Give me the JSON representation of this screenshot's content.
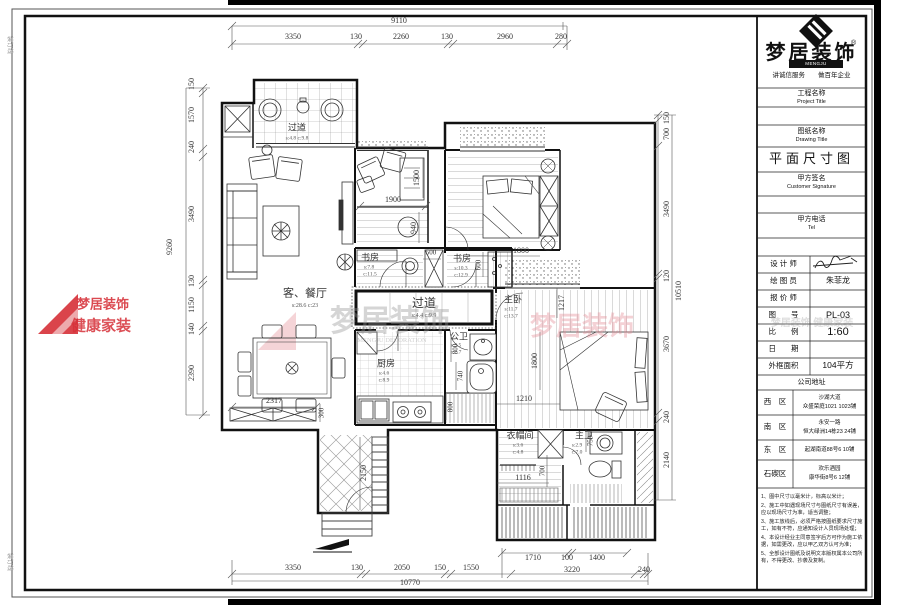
{
  "title_block": {
    "logo_text": "梦居装饰",
    "logo_reg": "®",
    "logo_sub": "MENGJU DECORATION",
    "slogan": "讲诚信服务　　做百年企业",
    "project_label_cn": "工程名称",
    "project_label_en": "Project Title",
    "drawing_label_cn": "图纸名称",
    "drawing_label_en": "Drawing Title",
    "drawing_title": "平面尺寸图",
    "signature_label_cn": "甲方签名",
    "signature_label_en": "Customer Signature",
    "tel_label_cn": "甲方电话",
    "tel_label_en": "Tel",
    "rows": [
      {
        "label": "设 计 师",
        "value": ""
      },
      {
        "label": "绘 图 员",
        "value": "朱菲龙"
      },
      {
        "label": "报 价 师",
        "value": ""
      },
      {
        "label": "图　　号",
        "value": "PL-03"
      },
      {
        "label": "比　　例",
        "value": "1:60"
      },
      {
        "label": "日　　期",
        "value": ""
      },
      {
        "label": "外框面积",
        "value": "104平方"
      }
    ],
    "address_header": "公司地址",
    "addresses": [
      {
        "district": "西　区",
        "line1": "沙湖大道",
        "line2": "众盛荣庭1021  1023铺"
      },
      {
        "district": "南　区",
        "line1": "永安一路",
        "line2": "恒大绿洲14栋23  24铺"
      },
      {
        "district": "东　区",
        "line1": "起湖南道88号6  10铺",
        "line2": ""
      },
      {
        "district": "石碶区",
        "line1": "欢乐酒园",
        "line2": "康华街8号6  12铺"
      }
    ],
    "notes": [
      "1、图中尺寸以毫米计，标高以米计；",
      "2、施工中如遇现场尺寸与图纸尺寸有误差，应以现场尺寸为准，适当调整；",
      "3、施工放线后，必须严格按图纸要求尺寸施工，如有不符，应通知设计人员现场处理；",
      "4、本设计经业主同意签字后方可作为施工依据，如需更改，应以甲乙双方认可为准；",
      "5、全部设计图纸及说明文本版权属本公司所有，不得更改、抄袭及复制。"
    ]
  },
  "accent_colors": {
    "brand_red": "#d63038",
    "line_dark": "#111111"
  },
  "plan": {
    "texts": [
      {
        "n": "dim-top-overall",
        "t": "9110",
        "x": 399,
        "y": 21
      },
      {
        "n": "dim",
        "t": "3350",
        "x": 293,
        "y": 37
      },
      {
        "n": "dim",
        "t": "130",
        "x": 356,
        "y": 37
      },
      {
        "n": "dim",
        "t": "2260",
        "x": 401,
        "y": 37
      },
      {
        "n": "dim",
        "t": "130",
        "x": 447,
        "y": 37
      },
      {
        "n": "dim",
        "t": "2960",
        "x": 505,
        "y": 37
      },
      {
        "n": "dim",
        "t": "280",
        "x": 561,
        "y": 37
      },
      {
        "n": "dim",
        "t": "1710",
        "x": 533,
        "y": 558
      },
      {
        "n": "dim",
        "t": "100",
        "x": 567,
        "y": 558
      },
      {
        "n": "dim",
        "t": "1400",
        "x": 597,
        "y": 558
      },
      {
        "n": "dim",
        "t": "3350",
        "x": 293,
        "y": 568
      },
      {
        "n": "dim",
        "t": "130",
        "x": 357,
        "y": 568
      },
      {
        "n": "dim",
        "t": "2050",
        "x": 402,
        "y": 568
      },
      {
        "n": "dim",
        "t": "150",
        "x": 440,
        "y": 568
      },
      {
        "n": "dim",
        "t": "1550",
        "x": 471,
        "y": 568
      },
      {
        "n": "dim",
        "t": "3220",
        "x": 572,
        "y": 570
      },
      {
        "n": "dim",
        "t": "240",
        "x": 644,
        "y": 570
      },
      {
        "n": "dim-bottom-overall",
        "t": "10770",
        "x": 410,
        "y": 583
      },
      {
        "n": "dim-left-overall",
        "t": "9260",
        "x": 170,
        "y": 247,
        "r": -90
      },
      {
        "n": "dim",
        "t": "150",
        "x": 192,
        "y": 84,
        "r": -90
      },
      {
        "n": "dim",
        "t": "1570",
        "x": 192,
        "y": 115,
        "r": -90
      },
      {
        "n": "dim",
        "t": "240",
        "x": 192,
        "y": 147,
        "r": -90
      },
      {
        "n": "dim",
        "t": "3490",
        "x": 192,
        "y": 214,
        "r": -90
      },
      {
        "n": "dim",
        "t": "130",
        "x": 192,
        "y": 281,
        "r": -90
      },
      {
        "n": "dim",
        "t": "1150",
        "x": 192,
        "y": 305,
        "r": -90
      },
      {
        "n": "dim",
        "t": "140",
        "x": 192,
        "y": 329,
        "r": -90
      },
      {
        "n": "dim",
        "t": "2390",
        "x": 192,
        "y": 373,
        "r": -90
      },
      {
        "n": "dim",
        "t": "150",
        "x": 667,
        "y": 118,
        "r": -90
      },
      {
        "n": "dim",
        "t": "700",
        "x": 667,
        "y": 134,
        "r": -90
      },
      {
        "n": "dim",
        "t": "3490",
        "x": 667,
        "y": 209,
        "r": -90
      },
      {
        "n": "dim",
        "t": "120",
        "x": 667,
        "y": 276,
        "r": -90
      },
      {
        "n": "dim-right-overall",
        "t": "10510",
        "x": 679,
        "y": 291,
        "r": -90
      },
      {
        "n": "dim",
        "t": "3670",
        "x": 667,
        "y": 344,
        "r": -90
      },
      {
        "n": "dim",
        "t": "240",
        "x": 667,
        "y": 417,
        "r": -90
      },
      {
        "n": "dim",
        "t": "2140",
        "x": 667,
        "y": 460,
        "r": -90
      },
      {
        "n": "dim",
        "t": "1900",
        "x": 393,
        "y": 200
      },
      {
        "n": "dim",
        "t": "1500",
        "x": 417,
        "y": 178,
        "r": -90
      },
      {
        "n": "dim",
        "t": "940",
        "x": 414,
        "y": 228,
        "r": -90
      },
      {
        "n": "dim",
        "t": "1800",
        "x": 521,
        "y": 251
      },
      {
        "n": "dim",
        "t": "500",
        "x": 431,
        "y": 253,
        "fs": 7
      },
      {
        "n": "dim",
        "t": "600",
        "x": 479,
        "y": 265,
        "r": -90,
        "fs": 7
      },
      {
        "n": "dim",
        "t": "1217",
        "x": 562,
        "y": 303,
        "r": -90
      },
      {
        "n": "dim",
        "t": "1800",
        "x": 535,
        "y": 361,
        "r": -90
      },
      {
        "n": "dim",
        "t": "1210",
        "x": 524,
        "y": 399
      },
      {
        "n": "dim",
        "t": "800",
        "x": 456,
        "y": 349,
        "r": -90,
        "fs": 7
      },
      {
        "n": "dim",
        "t": "740",
        "x": 461,
        "y": 376,
        "r": -90,
        "fs": 7
      },
      {
        "n": "dim",
        "t": "800",
        "x": 451,
        "y": 407,
        "r": -90,
        "fs": 7
      },
      {
        "n": "dim",
        "t": "750",
        "x": 591,
        "y": 441,
        "r": -90,
        "fs": 7
      },
      {
        "n": "dim",
        "t": "700",
        "x": 543,
        "y": 471,
        "r": -90,
        "fs": 7
      },
      {
        "n": "dim",
        "t": "1116",
        "x": 523,
        "y": 478
      },
      {
        "n": "dim",
        "t": "2317",
        "x": 274,
        "y": 401
      },
      {
        "n": "dim",
        "t": "300",
        "x": 322,
        "y": 413,
        "r": -90,
        "fs": 7
      },
      {
        "n": "dim",
        "t": "2150",
        "x": 364,
        "y": 473,
        "r": -90
      },
      {
        "n": "room-label",
        "t": "过道",
        "x": 297,
        "y": 128,
        "fs": 9
      },
      {
        "n": "room-sub",
        "t": "s:4.8 c:9.8",
        "x": 297,
        "y": 139,
        "fs": 5.5,
        "c": "#555"
      },
      {
        "n": "room-label",
        "t": "客、餐厅",
        "x": 305,
        "y": 294,
        "fs": 11
      },
      {
        "n": "room-sub",
        "t": "s:28.6 c:23",
        "x": 305,
        "y": 306,
        "fs": 6,
        "c": "#555"
      },
      {
        "n": "room-label",
        "t": "书房",
        "x": 370,
        "y": 258,
        "fs": 9
      },
      {
        "n": "room-sub",
        "t": "s:7.8",
        "x": 369,
        "y": 268,
        "fs": 5.5,
        "c": "#555"
      },
      {
        "n": "room-sub",
        "t": "c:11.5",
        "x": 370,
        "y": 275,
        "fs": 5.5,
        "c": "#555"
      },
      {
        "n": "room-label",
        "t": "书房",
        "x": 462,
        "y": 259,
        "fs": 9
      },
      {
        "n": "room-sub",
        "t": "s:10.3",
        "x": 461,
        "y": 269,
        "fs": 5.5,
        "c": "#555"
      },
      {
        "n": "room-sub",
        "t": "c:12.9",
        "x": 461,
        "y": 276,
        "fs": 5.5,
        "c": "#555"
      },
      {
        "n": "room-label",
        "t": "过道",
        "x": 424,
        "y": 303,
        "fs": 12
      },
      {
        "n": "room-sub",
        "t": "s:4.4 c:9.9",
        "x": 424,
        "y": 316,
        "fs": 6,
        "c": "#555"
      },
      {
        "n": "room-label",
        "t": "主卧",
        "x": 513,
        "y": 300,
        "fs": 9
      },
      {
        "n": "room-sub",
        "t": "s:11.7",
        "x": 511,
        "y": 310,
        "fs": 5.5,
        "c": "#555"
      },
      {
        "n": "room-sub",
        "t": "c:13.7",
        "x": 511,
        "y": 317,
        "fs": 5.5,
        "c": "#555"
      },
      {
        "n": "room-label",
        "t": "厨房",
        "x": 386,
        "y": 364,
        "fs": 9
      },
      {
        "n": "room-sub",
        "t": "s:4.6",
        "x": 384,
        "y": 374,
        "fs": 5.5,
        "c": "#555"
      },
      {
        "n": "room-sub",
        "t": "c:8.9",
        "x": 384,
        "y": 381,
        "fs": 5.5,
        "c": "#555"
      },
      {
        "n": "room-label",
        "t": "公卫",
        "x": 459,
        "y": 337,
        "fs": 9
      },
      {
        "n": "room-sub",
        "t": "s:3.5",
        "x": 456,
        "y": 346,
        "fs": 5.5,
        "c": "#555"
      },
      {
        "n": "room-sub",
        "t": "c:7.7",
        "x": 456,
        "y": 353,
        "fs": 5.5,
        "c": "#555"
      },
      {
        "n": "room-label",
        "t": "衣帽间",
        "x": 520,
        "y": 436,
        "fs": 9
      },
      {
        "n": "room-sub",
        "t": "s:3.6",
        "x": 518,
        "y": 446,
        "fs": 5.5,
        "c": "#555"
      },
      {
        "n": "room-sub",
        "t": "c:4.8",
        "x": 518,
        "y": 453,
        "fs": 5.5,
        "c": "#555"
      },
      {
        "n": "room-label",
        "t": "主卫",
        "x": 584,
        "y": 436,
        "fs": 9
      },
      {
        "n": "room-sub",
        "t": "s:2.9",
        "x": 577,
        "y": 446,
        "fs": 5.5,
        "c": "#555"
      },
      {
        "n": "room-sub",
        "t": "c:7.0",
        "x": 577,
        "y": 453,
        "fs": 5.5,
        "c": "#555"
      },
      {
        "n": "watermark-center-text",
        "t": "梦居装饰",
        "x": 390,
        "y": 322,
        "fs": 30,
        "c": "rgba(145,145,145,0.38)",
        "w": "bold"
      },
      {
        "n": "watermark-center-sub",
        "t": "MENGJU DECORATION",
        "x": 392,
        "y": 341,
        "fs": 6.5,
        "c": "rgba(150,150,150,0.45)"
      },
      {
        "n": "watermark-center-dots",
        "t": "·   ·   ·   ·   ·   ·",
        "x": 392,
        "y": 349,
        "fs": 6,
        "c": "rgba(160,160,160,0.4)"
      },
      {
        "n": "watermark-right-text",
        "t": "梦居装饰",
        "x": 582,
        "y": 327,
        "fs": 26,
        "c": "rgba(228,140,150,0.4)",
        "w": "bold"
      },
      {
        "n": "watermark-left-title",
        "t": "梦居装饰",
        "x": 103,
        "y": 304,
        "fs": 13,
        "c": "rgba(214,48,56,0.88)",
        "w": "bold"
      },
      {
        "n": "watermark-left-sub",
        "t": "健康家装",
        "x": 101,
        "y": 327,
        "fs": 15,
        "c": "rgba(214,48,56,0.85)",
        "w": "bold"
      },
      {
        "n": "watermark-titleblock",
        "t": "梦居装饰 健康家装",
        "x": 812,
        "y": 324,
        "fs": 10,
        "c": "rgba(150,150,150,0.32)",
        "w": "bold"
      },
      {
        "n": "binding-mark",
        "t": "装订线",
        "x": 9,
        "y": 45,
        "r": 90,
        "fs": 6,
        "c": "#999"
      },
      {
        "n": "binding-mark",
        "t": "装订线",
        "x": 9,
        "y": 562,
        "r": 90,
        "fs": 6,
        "c": "#999"
      }
    ]
  }
}
